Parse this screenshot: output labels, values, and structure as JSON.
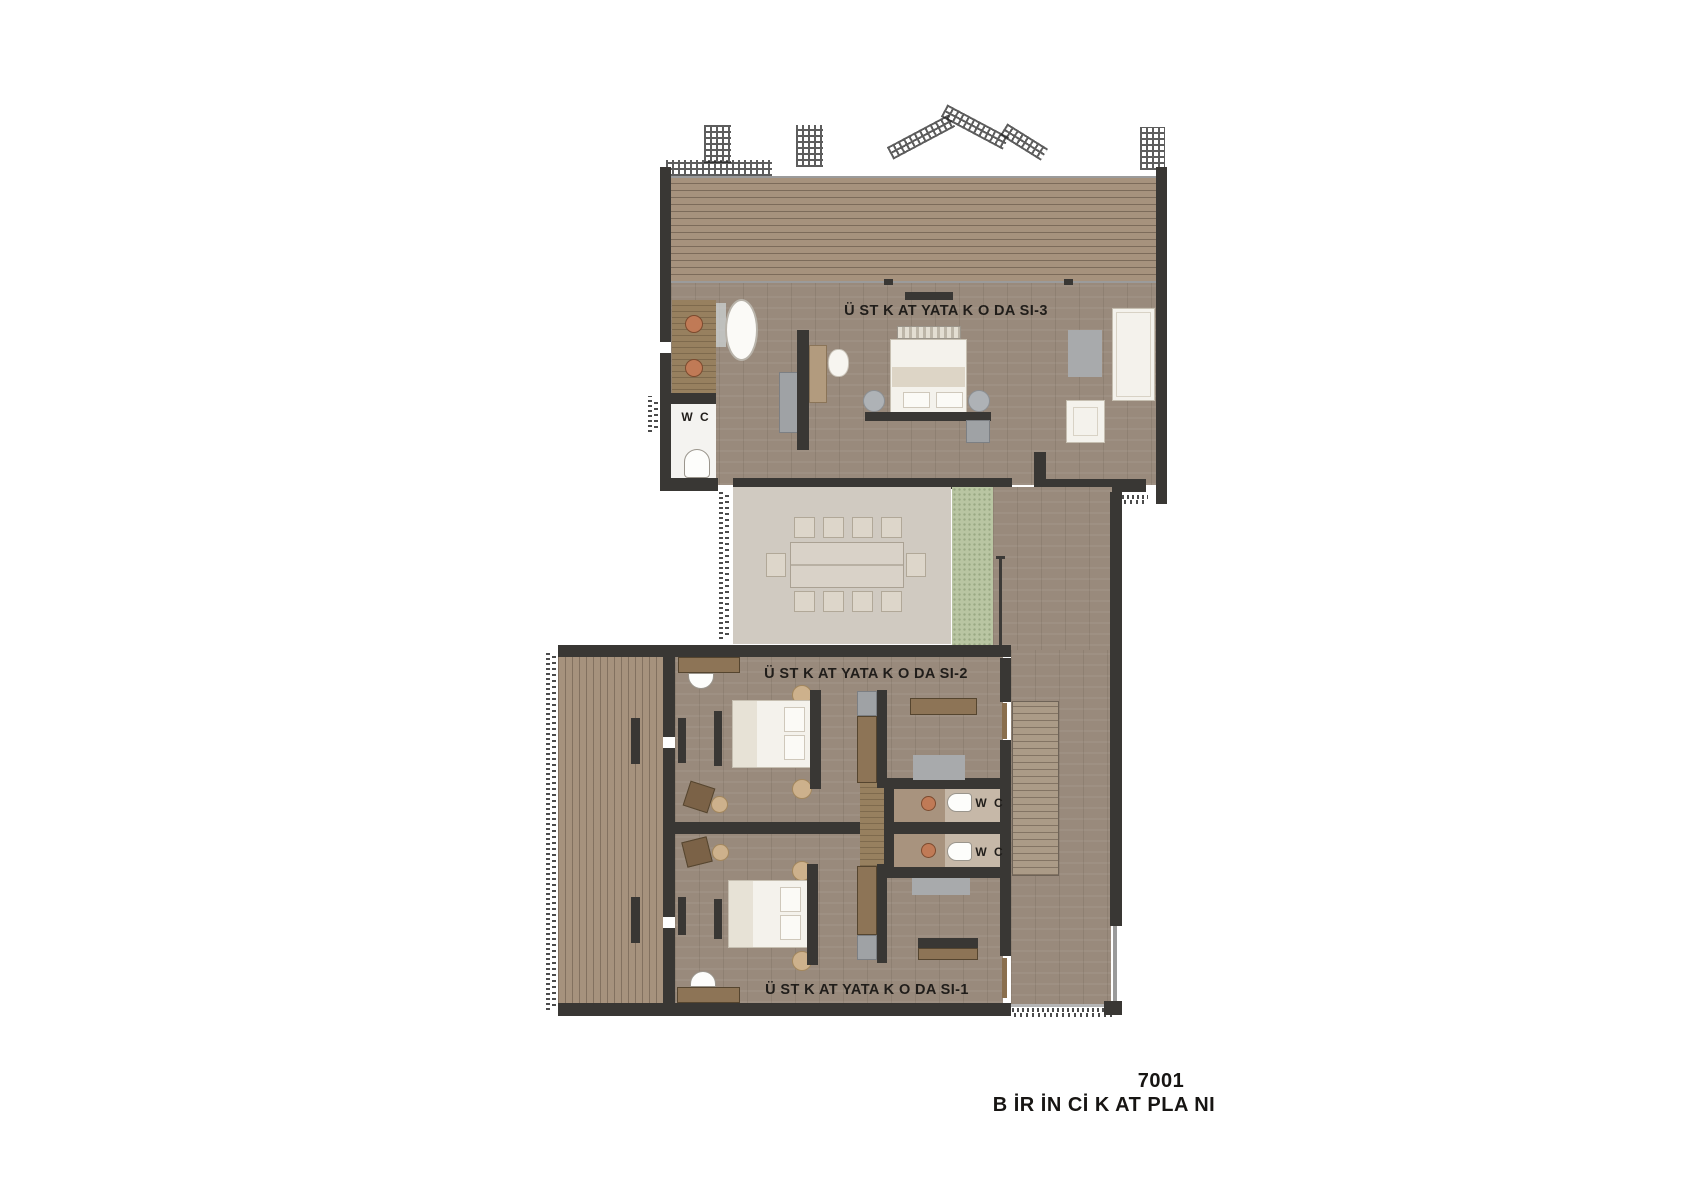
{
  "plan": {
    "drawing_number": "7001",
    "drawing_title": "B İR İN Cİ K AT PLA NI"
  },
  "labels": {
    "bedroom3": "Ü ST K AT YATA K O DA SI-3",
    "bedroom2": "Ü ST K AT YATA K O DA SI-2",
    "bedroom1": "Ü ST K AT YATA K O DA SI-1",
    "wc3": "W C",
    "wc2": "W C",
    "wc1": "W C"
  },
  "colors": {
    "wall": "#393734",
    "wood_floor": "#998a7c",
    "deck": "#a6927d",
    "rug": "#d0cac1",
    "grass": "#b9c5a2",
    "copper_sink": "#c07a56",
    "furniture_white": "#f4f2ec",
    "text": "#201d1a"
  }
}
